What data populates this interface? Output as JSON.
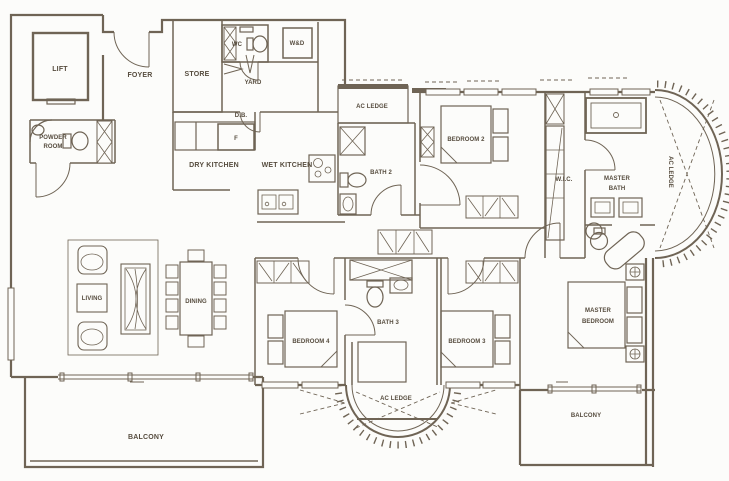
{
  "plan": {
    "type": "apartment-floor-plan",
    "colors": {
      "background": "#fcfcfa",
      "line": "#6f6455",
      "text": "#564c3e"
    },
    "rooms": {
      "lift": {
        "label": "LIFT"
      },
      "foyer": {
        "label": "FOYER"
      },
      "store": {
        "label": "STORE"
      },
      "wc": {
        "label": "WC"
      },
      "washer_dryer": {
        "label": "W&D"
      },
      "yard": {
        "label": "YARD"
      },
      "db": {
        "label": "D.B."
      },
      "fridge": {
        "label": "F"
      },
      "dry_kitchen": {
        "label": "DRY KITCHEN"
      },
      "wet_kitchen": {
        "label": "WET KITCHEN"
      },
      "powder_room": {
        "line1": "POWDER",
        "line2": "ROOM"
      },
      "ac_ledge_top": {
        "label": "AC LEDGE"
      },
      "bath2": {
        "label": "BATH 2"
      },
      "bedroom2": {
        "label": "BEDROOM 2"
      },
      "wic": {
        "label": "W.I.C."
      },
      "master_bath": {
        "line1": "MASTER",
        "line2": "BATH"
      },
      "ac_ledge_right": {
        "label": "AC LEDGE"
      },
      "living": {
        "label": "LIVING"
      },
      "dining": {
        "label": "DINING"
      },
      "bedroom4": {
        "label": "BEDROOM 4"
      },
      "bath3": {
        "label": "BATH 3"
      },
      "bedroom3": {
        "label": "BEDROOM 3"
      },
      "master_bedroom": {
        "line1": "MASTER",
        "line2": "BEDROOM"
      },
      "ac_ledge_bottom": {
        "label": "AC LEDGE"
      },
      "balcony_left": {
        "label": "BALCONY"
      },
      "balcony_right": {
        "label": "BALCONY"
      }
    }
  }
}
